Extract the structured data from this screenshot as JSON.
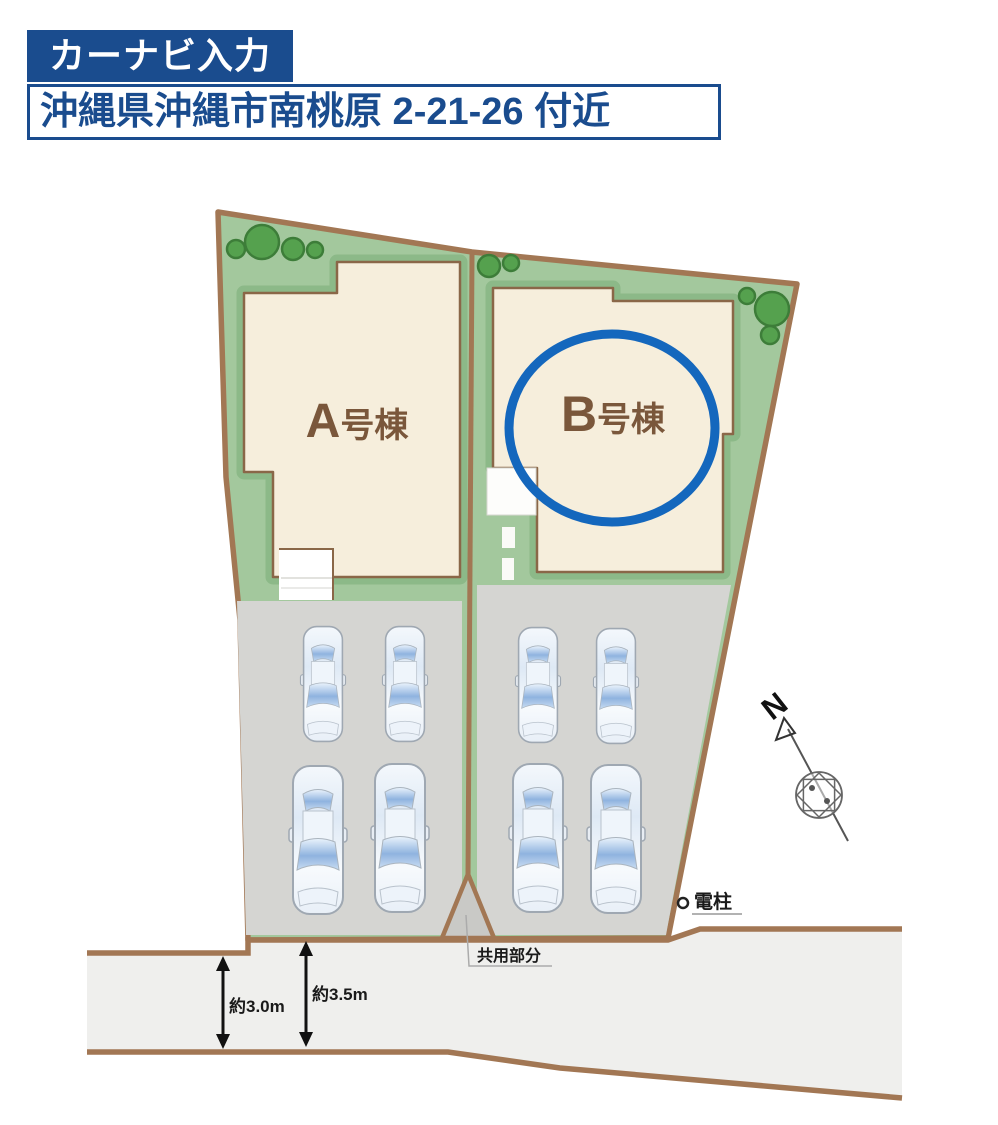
{
  "header": {
    "navi_button_label": "カーナビ入力",
    "address": "沖縄県沖縄市南桃原 2-21-26 付近"
  },
  "site_plan": {
    "building_a": {
      "letter": "A",
      "suffix": "号棟"
    },
    "building_b": {
      "letter": "B",
      "suffix": "号棟",
      "highlighted": true
    },
    "labels": {
      "common_area": "共用部分",
      "utility_pole": "電柱",
      "north": "N",
      "road_width_left": "約3.0m",
      "road_width_right": "約3.5m"
    },
    "parking": {
      "cars_lot_a": 4,
      "cars_lot_b": 4,
      "total_cars": 8
    }
  },
  "colors": {
    "header_navy": "#1A4C8E",
    "highlight_blue": "#1467BD",
    "border_brown": "#A27754",
    "building_outline_brown": "#8A6748",
    "building_fill": "#F6EEDC",
    "building_text_brown": "#7A573B",
    "grass_green": "#A3C89D",
    "grass_shade_green": "#8CB988",
    "tree_green": "#55A14E",
    "parking_gray": "#D5D5D2",
    "common_area_gray": "#C9C9C6",
    "road_gray": "#EFEFED"
  }
}
